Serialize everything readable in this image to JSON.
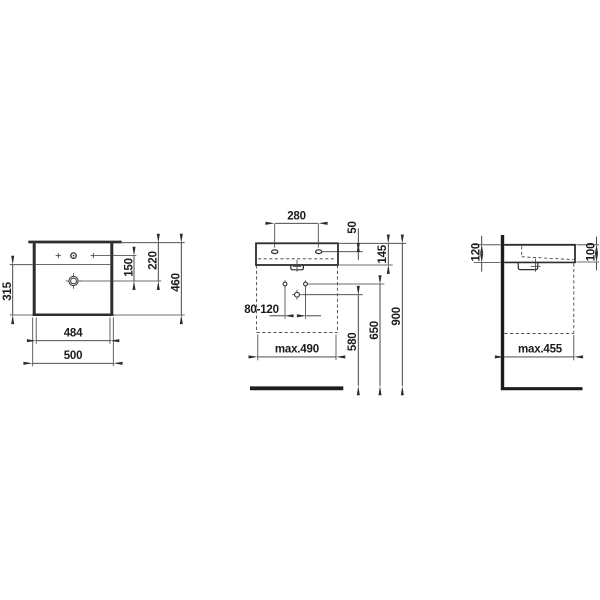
{
  "drawing": {
    "type": "technical-dimension-drawing",
    "product": "wall-mounted washbasin",
    "unit": "mm",
    "front_view": {
      "bowl_depth_height": "315",
      "tap_drain_spacing": "150",
      "rim_to_drain": "220",
      "overall_height": "460",
      "inner_width": "484",
      "outer_width": "500"
    },
    "installation_view": {
      "tap_hole_spacing": "280",
      "rim_to_tap_hole": "50",
      "body_height": "145",
      "outlet_offset_range": "80-120",
      "clearance_width": "max.490",
      "drain_outlet_height": "580",
      "fixing_height": "650",
      "rim_height": "900"
    },
    "side_view": {
      "height_at_wall": "120",
      "height_at_front": "100",
      "clearance_depth": "max.455"
    }
  }
}
